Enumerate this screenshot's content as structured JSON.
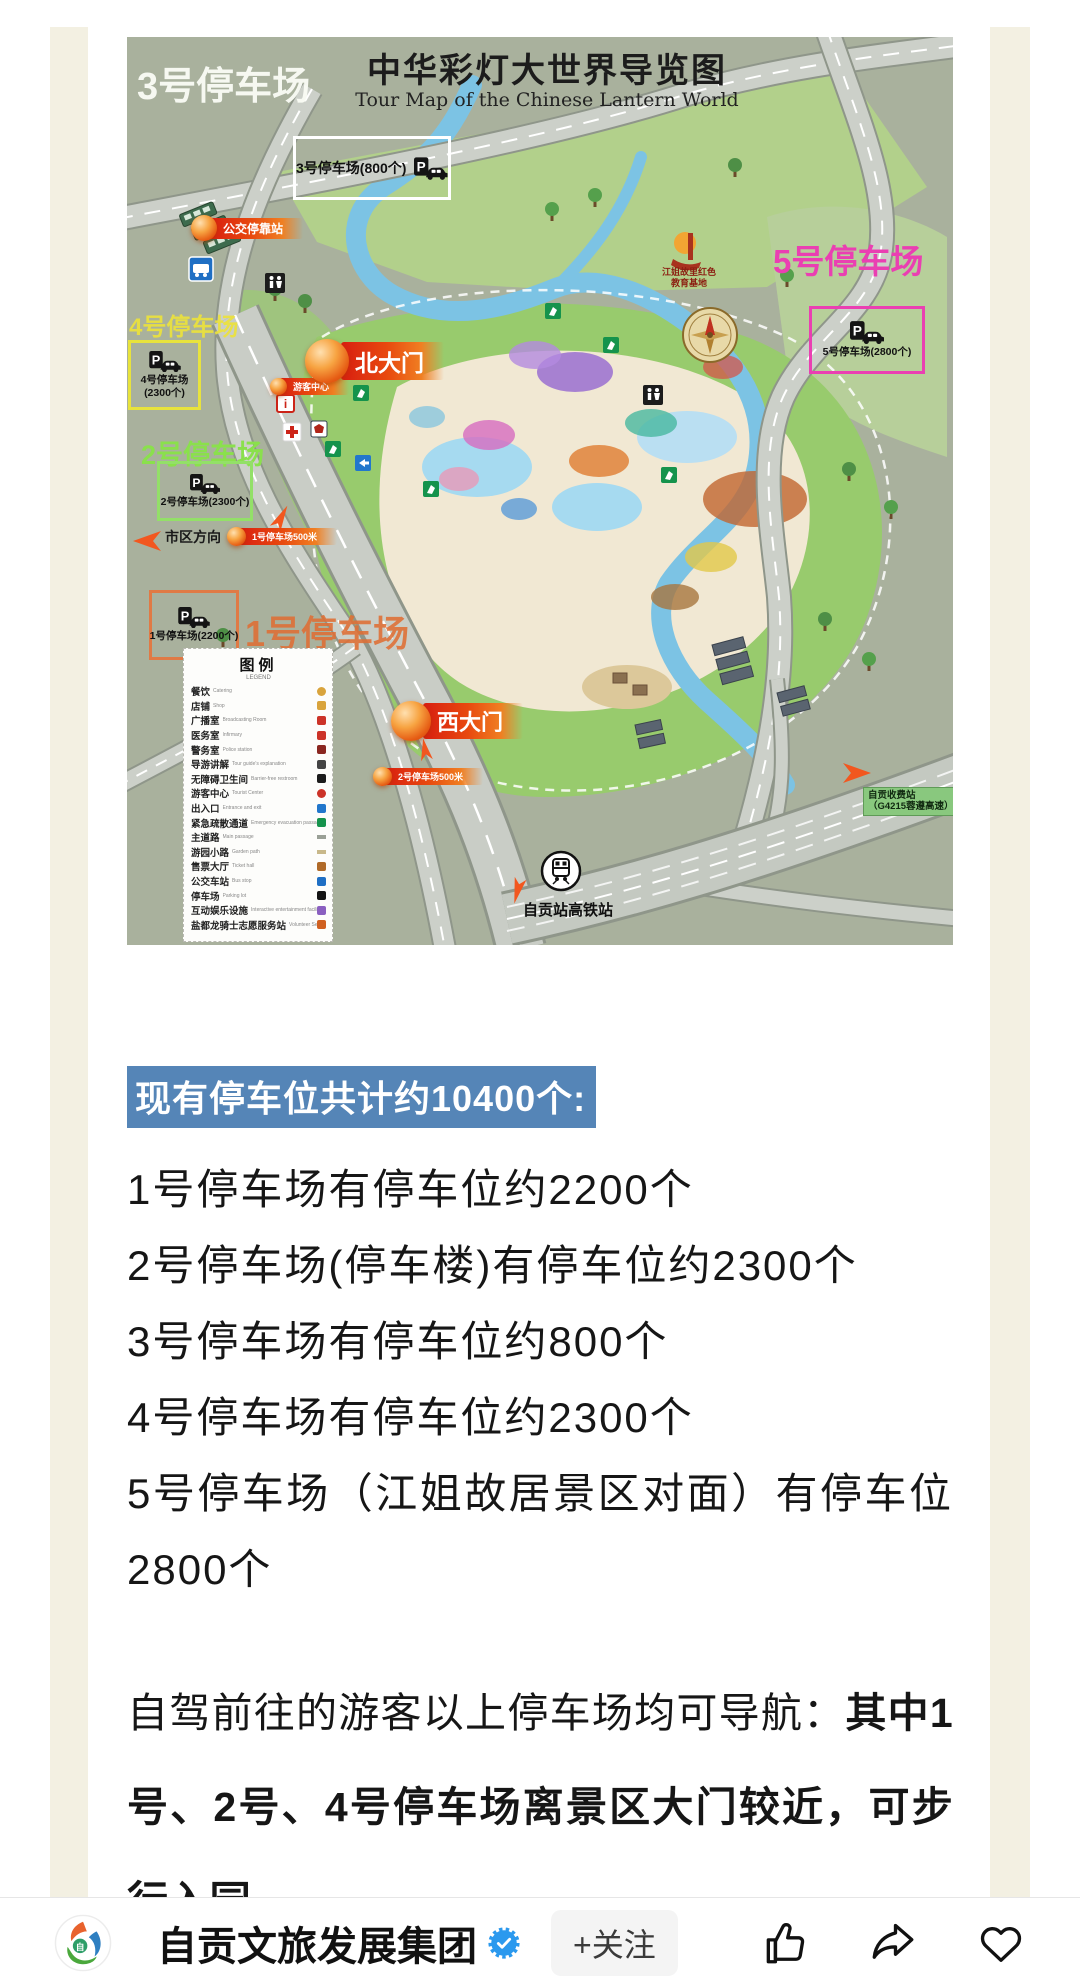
{
  "page": {
    "accent_blue": "#5585b7",
    "stripe_color": "#f3f0e2"
  },
  "map": {
    "title": "中华彩灯大世界导览图",
    "subtitle": "Tour Map of the Chinese Lantern World",
    "zone_labels": {
      "z3": "3号停车场",
      "z4": "4号停车场",
      "z2": "2号停车场",
      "z1": "1号停车场",
      "z5": "5号停车场"
    },
    "parking_boxes": {
      "p3": {
        "label": "3号停车场(800个)",
        "color": "#ffffff"
      },
      "p4": {
        "line1": "4号停车场",
        "line2": "(2300个)",
        "color": "#e8e33c"
      },
      "p2": {
        "label": "2号停车场(2300个)",
        "color": "#93e068"
      },
      "p1": {
        "label": "1号停车场(2200个)",
        "color": "#e07a45"
      },
      "p5": {
        "label": "5号停车场(2800个)",
        "color": "#ea3fb2"
      }
    },
    "markers": {
      "bus_stop": "公交停靠站",
      "north_gate": "北大门",
      "visitor_center": "游客中心",
      "west_gate": "西大门",
      "p1_distance": "1号停车场500米",
      "p2_distance": "2号停车场500米"
    },
    "poi": {
      "city_direction": "市区方向",
      "jiangjie_line1": "江姐故里红色",
      "jiangjie_line2": "教育基地",
      "toll_line1": "自贡收费站",
      "toll_line2": "（G4215蓉遵高速）",
      "train_station": "自贡站高铁站"
    },
    "legend": {
      "title": "图例",
      "subtitle": "LEGEND",
      "items": [
        {
          "zh": "餐饮",
          "en": "Catering"
        },
        {
          "zh": "店铺",
          "en": "Shop"
        },
        {
          "zh": "广播室",
          "en": "Broadcasting Room"
        },
        {
          "zh": "医务室",
          "en": "Infirmary"
        },
        {
          "zh": "警务室",
          "en": "Police station"
        },
        {
          "zh": "导游讲解",
          "en": "Tour guide's explanation"
        },
        {
          "zh": "无障碍卫生间",
          "en": "Barrier-free restroom"
        },
        {
          "zh": "游客中心",
          "en": "Tourist Center"
        },
        {
          "zh": "出入口",
          "en": "Entrance and exit"
        },
        {
          "zh": "紧急疏散通道",
          "en": "Emergency evacuation passage"
        },
        {
          "zh": "主道路",
          "en": "Main passage"
        },
        {
          "zh": "游园小路",
          "en": "Garden path"
        },
        {
          "zh": "售票大厅",
          "en": "Ticket hall"
        },
        {
          "zh": "公交车站",
          "en": "Bus stop"
        },
        {
          "zh": "停车场",
          "en": "Parking lot"
        },
        {
          "zh": "互动娱乐设施",
          "en": "Interactive entertainment facilities"
        },
        {
          "zh": "盐都龙骑士志愿服务站",
          "en": "Volunteer Service Station"
        }
      ]
    }
  },
  "article": {
    "heading": "现有停车位共计约10400个:",
    "lines": [
      "1号停车场有停车位约2200个",
      "2号停车场(停车楼)有停车位约2300个",
      "3号停车场有停车位约800个",
      "4号停车场有停车位约2300个",
      "5号停车场（江姐故居景区对面）有停车位2800个"
    ],
    "para_normal": "自驾前往的游客以上停车场均可导航：",
    "para_bold": "其中1号、2号、4号停车场离景区大门较近，可步行入园。"
  },
  "footer": {
    "account_name": "自贡文旅发展集团",
    "follow_label": "+关注"
  }
}
